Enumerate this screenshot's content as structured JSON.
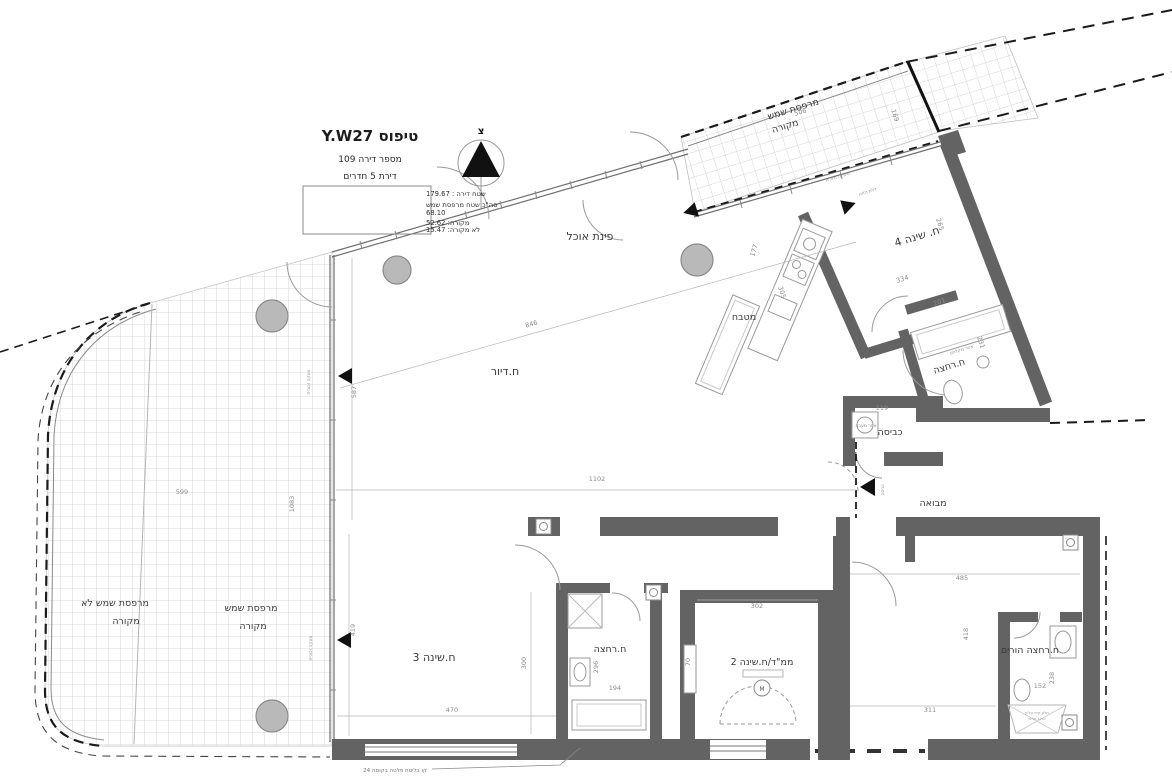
{
  "title_block": {
    "type_label": "טיפוס Y.W27",
    "apartment": "מספר דירה 109",
    "rooms_count": "דירת 5 חדרים",
    "area": "שטח דירה : 179.67",
    "balcony_total_label": "סה\"כ שטח מרפסת שמש",
    "balcony_total_value": "68.10",
    "covered": "מקורה: 52.62",
    "uncovered": "לא מקורה: 15.47"
  },
  "north_label": "צ",
  "rooms": {
    "living": "ח.דיור",
    "dining": "פינת אוכל",
    "kitchen": "מטבח",
    "bedroom4": "ח. שינה 4",
    "bathroom": "ח.רחצה",
    "laundry": "כביסה",
    "foyer": "מבואה",
    "entrance": "כניסה",
    "bedroom3": "ח.שינה 3",
    "bathroom2": "ח.רחצה",
    "mamad": "ממ\"ד/ח.שינה 2",
    "parents_bath": "ח.רחצה הורים",
    "balcony_line1": "מרפסת שמש",
    "balcony_line2": "מקורה",
    "balcony_uncov_line1": "מרפסת שמש לא",
    "balcony_uncov_line2": "מקורה"
  },
  "annotations": {
    "m": "M",
    "shower": "אזור מקלחון",
    "condenser": "אזור מעבה",
    "glass_rail": "מעקה זכוכית",
    "sliding_door": "דלת הזזה",
    "window_note1": "חלון קיפ עליון",
    "window_note2": "ארגז תריס",
    "beam_note": "קו בליטת פלטה בקומה 24"
  },
  "dims": {
    "d846": "846",
    "d1102": "1102",
    "d587": "587",
    "d599": "599",
    "d1083": "1083",
    "d419": "419",
    "d470": "470",
    "d300": "300",
    "d194": "194",
    "d296": "296",
    "d70": "70",
    "d302": "302",
    "d311": "311",
    "d418": "418",
    "d485": "485",
    "d152": "152",
    "d238": "238",
    "d177": "177",
    "d334": "334",
    "d265": "265",
    "d201": "201",
    "d231": "231",
    "d119": "119",
    "d506": "506",
    "d169": "169",
    "d305": "305"
  },
  "colors": {
    "wall": "#636363",
    "hatch": "#d9d9d9",
    "dash": "#1b1b1b",
    "fixture": "#9a9a9a",
    "column": "#b9b9b9"
  }
}
